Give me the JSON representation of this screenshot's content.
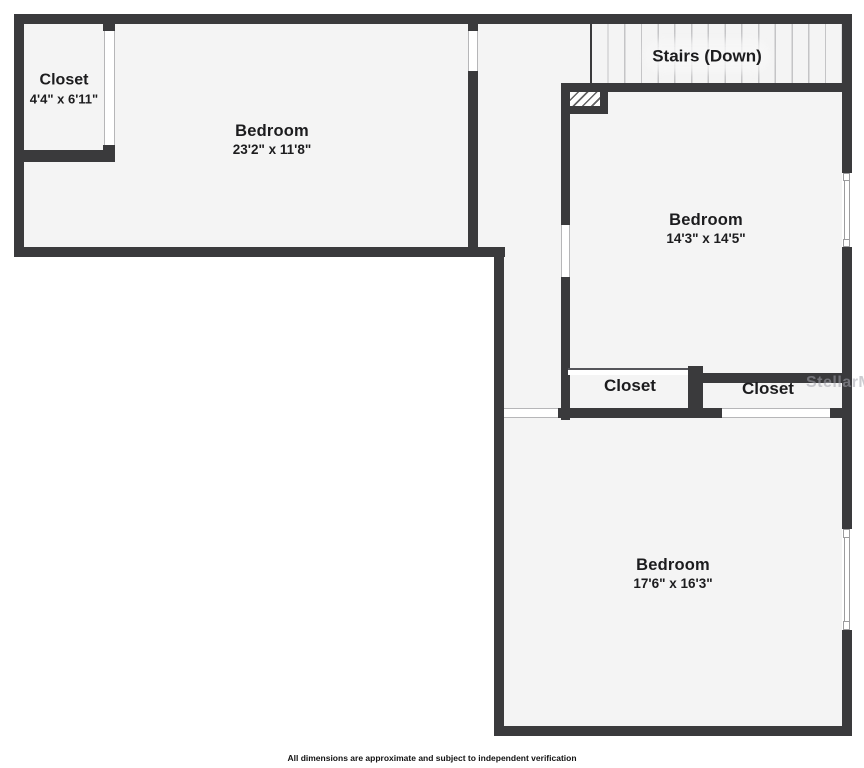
{
  "colors": {
    "wall": "#3a3a3c",
    "floor": "#f4f4f4",
    "background": "#ffffff",
    "stair_tread_line": "#c4c4c6",
    "label_text": "#1c1c1e",
    "watermark": "#a3a3ab"
  },
  "rooms": {
    "closet_top_left": {
      "name": "Closet",
      "dims": "4'4\" x 6'11\""
    },
    "bedroom_left": {
      "name": "Bedroom",
      "dims": "23'2\" x 11'8\""
    },
    "stairs": {
      "label": "Stairs (Down)"
    },
    "bedroom_right": {
      "name": "Bedroom",
      "dims": "14'3\" x 14'5\""
    },
    "closet_middle": {
      "name": "Closet"
    },
    "closet_right": {
      "name": "Closet"
    },
    "bedroom_bottom": {
      "name": "Bedroom",
      "dims": "17'6\" x 16'3\""
    }
  },
  "watermark": {
    "text": "StellarMLS"
  },
  "footer": {
    "disclaimer": "All dimensions are approximate and subject to independent verification"
  }
}
